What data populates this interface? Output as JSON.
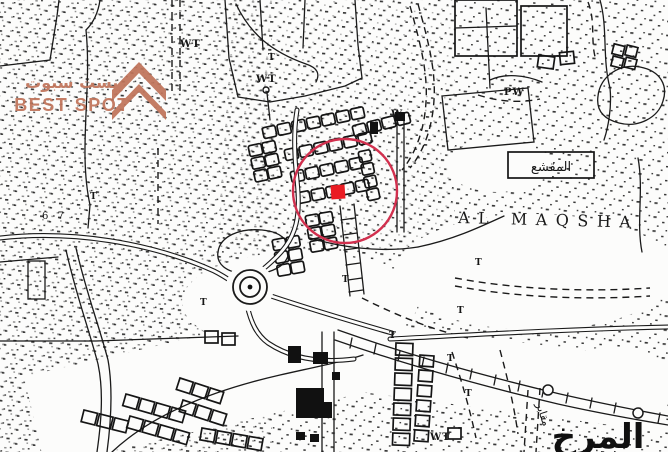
{
  "watermark": {
    "arabic": "بيست سبوت",
    "latin": "BEST SPOT",
    "color": "#c0745a",
    "icon": "double-chevron-up"
  },
  "annotation": {
    "circle": {
      "cx": 345,
      "cy": 191,
      "r": 52,
      "color": "#d2304e"
    },
    "marker": {
      "x": 331,
      "y": 185,
      "size": 14,
      "color": "#ea1c23"
    }
  },
  "labels": {
    "al_maqsha": "AL MAQSHA",
    "wt": "WT",
    "pw": "PW",
    "w": "W",
    "six_seven": "6 7",
    "t_mark": "T",
    "arabic_box": "المقشع",
    "arabic_large": "المرخ",
    "arabic_small": "مقابر"
  },
  "map_style": {
    "ink": "#1a1a1a",
    "paper": "#fcfcfb"
  }
}
